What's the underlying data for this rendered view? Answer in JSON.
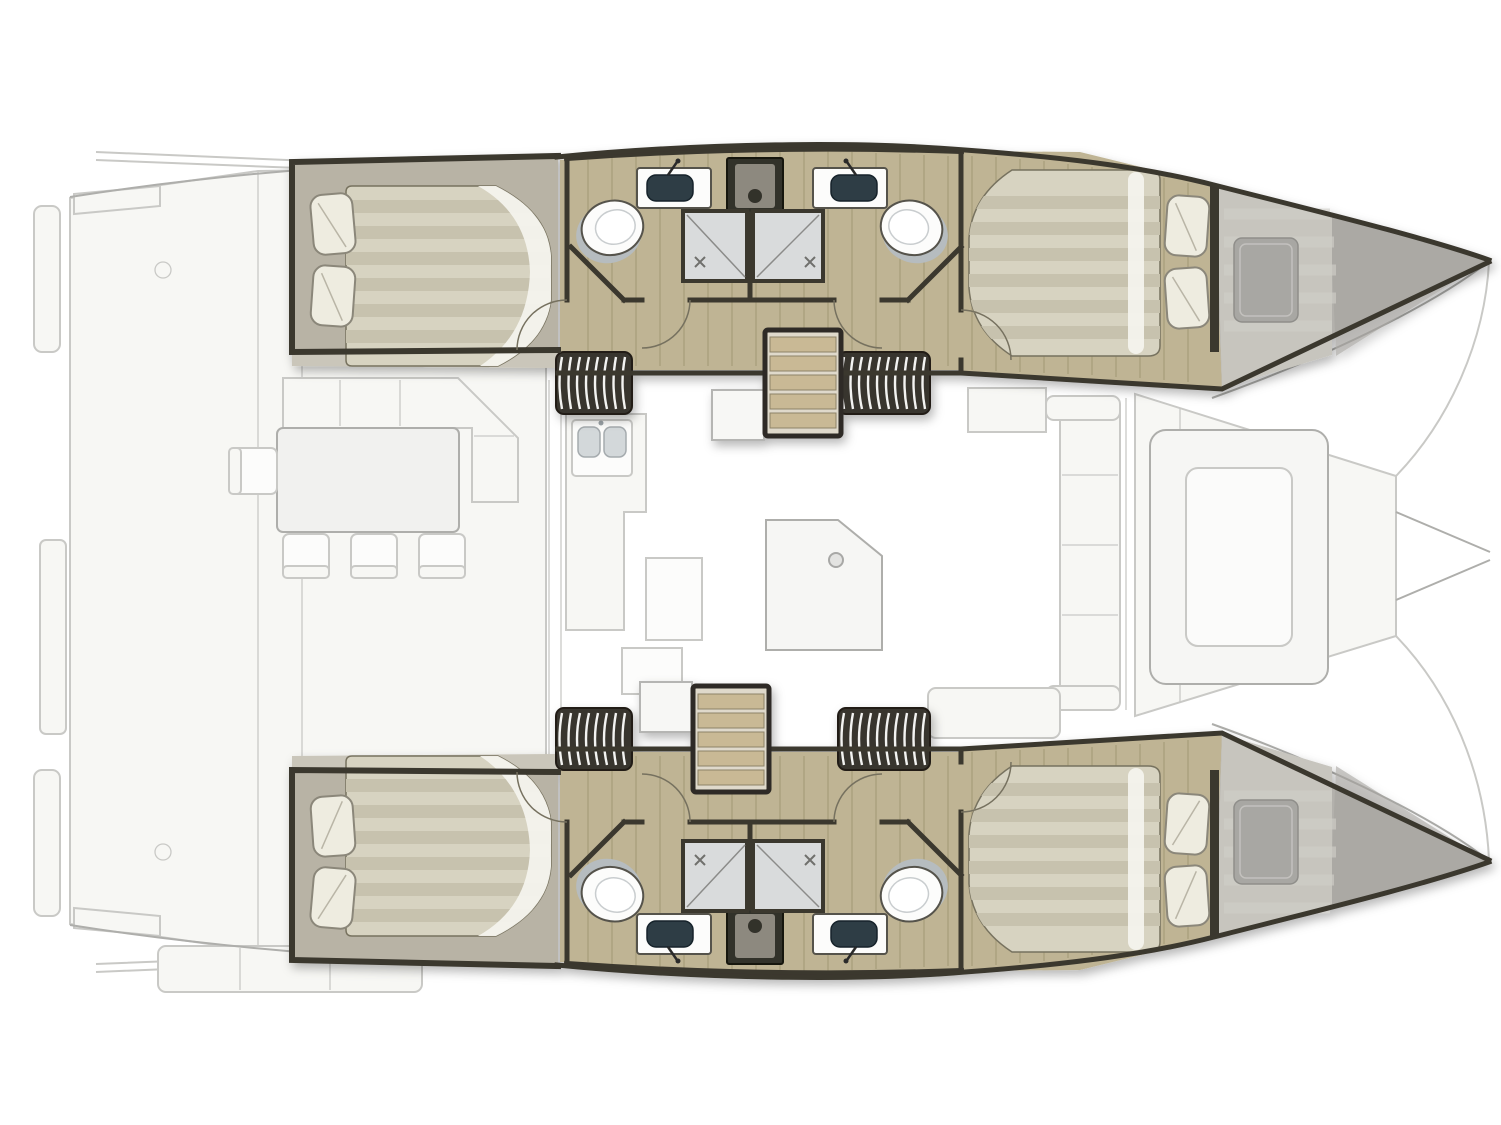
{
  "image": {
    "title": "Catamaran interior floor plan - top-down deck layout, 4 double cabins, 2 hull bathrooms, ghosted saloon and cockpit",
    "width": 1501,
    "height": 1125
  },
  "palette": {
    "background": "#ffffff",
    "ghost_fill": "#f7f7f4",
    "ghost_line": "#c9c9c6",
    "ghost_line_strong": "#aeaeab",
    "wall": "#3b372f",
    "wood": "#bfb494",
    "wood_line": "#a89d7c",
    "floor_greige": "#b8b3a5",
    "deck_strip": "#cac6ba",
    "mattress": "#d7d3c1",
    "mattress_stripe": "#c7c2ae",
    "mattress_highlight": "#f4f3ed",
    "pillow": "#eeece0",
    "pillow_line": "#8b877a",
    "bow_floor": "#c7c5be",
    "bow_pad": "#a8a7a3",
    "wedge": "#b3b1ac",
    "wedge_dark": "#a5a39e",
    "shower_floor": "#d9dbdc",
    "fixture_white": "#fcfcfb",
    "fixture_line": "#55524b",
    "basin": "#2d3c44",
    "louver_dark": "#38352f",
    "louver_light": "#f3f3f1",
    "stair_wood": "#c9b995",
    "stair_frame": "#2e2b26",
    "stair_void": "#dfd9cb",
    "utility_dark": "#33302b",
    "utility_mid": "#8d897f"
  },
  "layout": {
    "orientation": "bows-pointing-right",
    "hulls": [
      {
        "id": "hull-top",
        "rooms": [
          {
            "name": "aft-double-cabin",
            "bed": "island-double",
            "pillows": 2
          },
          {
            "name": "bathroom-aft",
            "fixtures": [
              "toilet",
              "washbasin",
              "shower"
            ]
          },
          {
            "name": "bathroom-forward",
            "fixtures": [
              "toilet",
              "washbasin",
              "shower"
            ]
          },
          {
            "name": "forward-double-cabin",
            "bed": "island-double",
            "pillows": 2
          },
          {
            "name": "bow-berth-storage"
          }
        ],
        "companionway": "wood-stairs-from-saloon"
      },
      {
        "id": "hull-bottom",
        "rooms": [
          {
            "name": "aft-double-cabin",
            "bed": "island-double",
            "pillows": 2
          },
          {
            "name": "bathroom-aft",
            "fixtures": [
              "toilet",
              "washbasin",
              "shower"
            ]
          },
          {
            "name": "bathroom-forward",
            "fixtures": [
              "toilet",
              "washbasin",
              "shower"
            ]
          },
          {
            "name": "forward-double-cabin",
            "bed": "island-double",
            "pillows": 2
          },
          {
            "name": "bow-berth-storage"
          }
        ],
        "companionway": "wood-stairs-from-saloon"
      }
    ],
    "deck_ghosted": {
      "aft_cockpit": [
        "transom-platforms",
        "l-shaped-sofa",
        "dining-table",
        "chairs-x4",
        "aft-bench"
      ],
      "saloon": [
        "galley-with-double-sink",
        "counters",
        "nav-pod",
        "side-settee",
        "storage-boxes"
      ],
      "foredeck": [
        "panelled-deck",
        "forward-seating-u",
        "bowsprit-lines"
      ]
    }
  }
}
